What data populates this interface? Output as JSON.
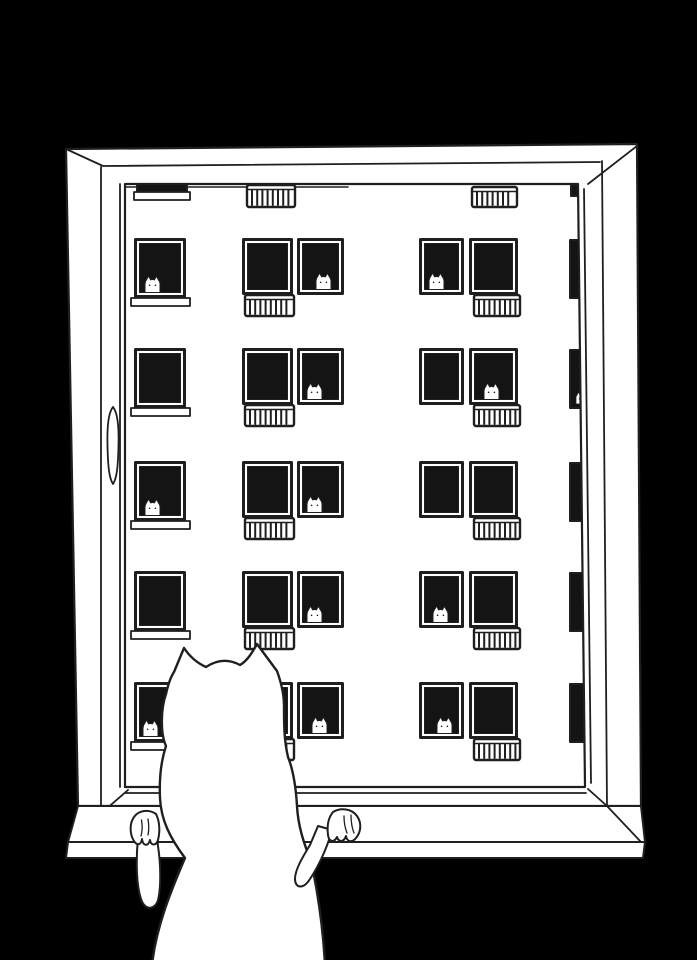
{
  "scene": {
    "medium": "black and white ink line illustration",
    "subject": "White cat seen from behind with front paws on a windowsill, looking out a window at an apartment building where small cats peek from dark windows",
    "colors": {
      "background": "#000000",
      "paper": "#ffffff",
      "ink": "#1f1f1f",
      "window_dark": "#141414"
    },
    "window_cat_count": 13,
    "building_rows": 5
  },
  "building": {
    "facade": {
      "x": 125,
      "y": 184,
      "w": 463,
      "h": 604
    },
    "floor_line": {
      "x1": 126,
      "x2": 348,
      "y": 187
    },
    "row_y": [
      238,
      348,
      461,
      571,
      682
    ],
    "single_col": {
      "x": 134,
      "w": 52,
      "h": 60,
      "sill_h": 8
    },
    "mid_cluster": {
      "left": {
        "x": 242,
        "w": 51
      },
      "right": {
        "x": 297,
        "w": 47
      },
      "h": 57
    },
    "right_cluster": {
      "left": {
        "x": 419,
        "w": 45
      },
      "right": {
        "x": 469,
        "w": 49
      },
      "h": 57
    },
    "balconies": {
      "mid": {
        "under": "left",
        "dx": 2,
        "w": 51
      },
      "right": {
        "under": "right",
        "dx": 4,
        "w": 48
      },
      "h": 23
    },
    "edge_strip": {
      "x": 570,
      "w": 18,
      "h": 58
    },
    "top_partials": {
      "left_window": {
        "x": 137,
        "y": 179,
        "w": 50,
        "h": 13
      },
      "left_sill": {
        "x": 134,
        "y": 192,
        "w": 56,
        "h": 8
      },
      "mid_balcony": {
        "x": 246,
        "y": 184,
        "w": 50,
        "h": 24
      },
      "right_balcony": {
        "x": 471,
        "y": 186,
        "w": 47,
        "h": 22
      },
      "edge_sliver": {
        "x": 571,
        "y": 185,
        "w": 14,
        "h": 11
      }
    },
    "window_cats": [
      {
        "row": 0,
        "spot": "single",
        "x": 145
      },
      {
        "row": 0,
        "spot": "mid_right",
        "x": 316
      },
      {
        "row": 0,
        "spot": "right_left",
        "x": 429
      },
      {
        "row": 1,
        "spot": "mid_right",
        "x": 307
      },
      {
        "row": 1,
        "spot": "right_right",
        "x": 484
      },
      {
        "row": 1,
        "spot": "strip",
        "x": 576,
        "scale": 0.72
      },
      {
        "row": 2,
        "spot": "single",
        "x": 145
      },
      {
        "row": 2,
        "spot": "mid_right",
        "x": 307
      },
      {
        "row": 3,
        "spot": "mid_right",
        "x": 307
      },
      {
        "row": 3,
        "spot": "right_left",
        "x": 433
      },
      {
        "row": 4,
        "spot": "single",
        "x": 143
      },
      {
        "row": 4,
        "spot": "mid_right",
        "x": 312
      },
      {
        "row": 4,
        "spot": "right_left",
        "x": 437
      }
    ]
  },
  "window_frame": {
    "handle_present": true,
    "sill_present": true
  },
  "foreground_cat": {
    "pose": "back view, standing up with both front paws on the windowsill",
    "color": "white with dark outline"
  }
}
